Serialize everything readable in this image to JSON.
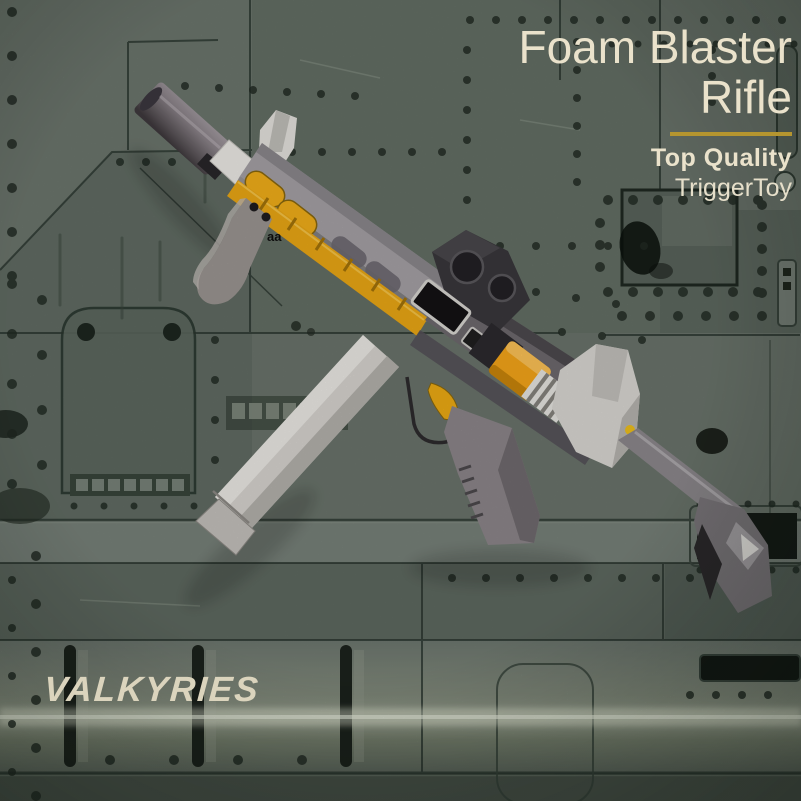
{
  "image_type": "product-photo",
  "branding": {
    "title_line1": "Foam Blaster",
    "title_line2": "Rifle",
    "tagline": "Top Quality",
    "brand": "TriggerToy",
    "watermark": "VALKYRIES",
    "stray_mark": "aa"
  },
  "colors": {
    "title_text": "#eae2cb",
    "accent_gold": "#b5952f",
    "watermark_text": "#dbd4bd",
    "background_panel": "#68726a",
    "blaster_yellow": "#f2ae16",
    "blaster_orange": "#f7a71a",
    "blaster_gray": "#a7a3a7",
    "magazine_gray": "#dad7d2"
  },
  "scene": {
    "background": "riveted military-green metal panels",
    "subject": "gray toy foam blaster rifle with suppressor, red dot sight, yellow accents and long magazine"
  }
}
